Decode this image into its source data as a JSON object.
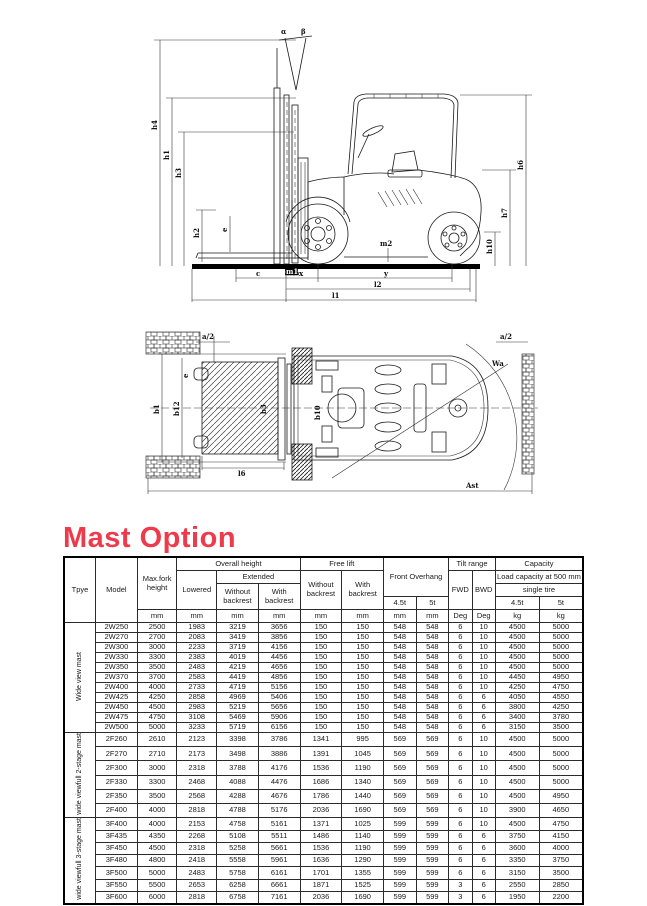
{
  "page": {
    "heading": "Mast Option",
    "heading_color": "#ee3b4b"
  },
  "side_view": {
    "labels": {
      "alpha": "α",
      "beta": "β",
      "h4": "h4",
      "h1": "h1",
      "h3": "h3",
      "h2": "h2",
      "e": "e",
      "m1": "m1",
      "m2": "m2",
      "h6": "h6",
      "h7": "h7",
      "h10": "h10",
      "c": "c",
      "x": "x",
      "y": "y",
      "l2": "l2",
      "l1": "l1"
    }
  },
  "top_view": {
    "labels": {
      "a2_left": "a/2",
      "a2_right": "a/2",
      "e": "e",
      "b1": "b1",
      "b12": "b12",
      "b3": "b3",
      "b10": "b10",
      "wa": "Wa",
      "l6": "l6",
      "ast": "Ast"
    }
  },
  "table": {
    "header": {
      "type": "Tpye",
      "model": "Model",
      "max_fork_height": "Max.fork height",
      "overall_height": "Overall height",
      "lowered": "Lowered",
      "extended": "Extended",
      "ext_without": "Without backrest",
      "ext_with": "With backrest",
      "free_lift": "Free lift",
      "fl_without": "Without backrest",
      "fl_with": "With backrest",
      "front_overhang": "Front  Overhang",
      "tilt_range": "Tilt range",
      "fwd": "FWD",
      "bwd": "BWD",
      "capacity": "Capacity",
      "load_capacity": "Load capacity at 500 mm",
      "single_tire": "single tire",
      "fo_45": "4.5t",
      "fo_5": "5t",
      "cap_45": "4.5t",
      "cap_5": "5t",
      "units": [
        "mm",
        "mm",
        "mm",
        "mm",
        "mm",
        "mm",
        "mm",
        "mm",
        "Deg",
        "Deg",
        "kg",
        "kg"
      ]
    },
    "groups": [
      {
        "type": "Wide view mast",
        "rows": [
          [
            "2W250",
            "2500",
            "1983",
            "3219",
            "3656",
            "150",
            "150",
            "548",
            "548",
            "6",
            "10",
            "4500",
            "5000"
          ],
          [
            "2W270",
            "2700",
            "2083",
            "3419",
            "3856",
            "150",
            "150",
            "548",
            "548",
            "6",
            "10",
            "4500",
            "5000"
          ],
          [
            "2W300",
            "3000",
            "2233",
            "3719",
            "4156",
            "150",
            "150",
            "548",
            "548",
            "6",
            "10",
            "4500",
            "5000"
          ],
          [
            "2W330",
            "3300",
            "2383",
            "4019",
            "4456",
            "150",
            "150",
            "548",
            "548",
            "6",
            "10",
            "4500",
            "5000"
          ],
          [
            "2W350",
            "3500",
            "2483",
            "4219",
            "4656",
            "150",
            "150",
            "548",
            "548",
            "6",
            "10",
            "4500",
            "5000"
          ],
          [
            "2W370",
            "3700",
            "2583",
            "4419",
            "4856",
            "150",
            "150",
            "548",
            "548",
            "6",
            "10",
            "4450",
            "4950"
          ],
          [
            "2W400",
            "4000",
            "2733",
            "4719",
            "5156",
            "150",
            "150",
            "548",
            "548",
            "6",
            "10",
            "4250",
            "4750"
          ],
          [
            "2W425",
            "4250",
            "2858",
            "4969",
            "5406",
            "150",
            "150",
            "548",
            "548",
            "6",
            "6",
            "4050",
            "4550"
          ],
          [
            "2W450",
            "4500",
            "2983",
            "5219",
            "5656",
            "150",
            "150",
            "548",
            "548",
            "6",
            "6",
            "3800",
            "4250"
          ],
          [
            "2W475",
            "4750",
            "3108",
            "5469",
            "5906",
            "150",
            "150",
            "548",
            "548",
            "6",
            "6",
            "3400",
            "3780"
          ],
          [
            "2W500",
            "5000",
            "3233",
            "5719",
            "6156",
            "150",
            "150",
            "548",
            "548",
            "6",
            "6",
            "3150",
            "3500"
          ]
        ]
      },
      {
        "type": "wide viewfull 2-stage mast",
        "rows": [
          [
            "2F260",
            "2610",
            "2123",
            "3398",
            "3786",
            "1341",
            "995",
            "569",
            "569",
            "6",
            "10",
            "4500",
            "5000"
          ],
          [
            "2F270",
            "2710",
            "2173",
            "3498",
            "3886",
            "1391",
            "1045",
            "569",
            "569",
            "6",
            "10",
            "4500",
            "5000"
          ],
          [
            "2F300",
            "3000",
            "2318",
            "3788",
            "4176",
            "1536",
            "1190",
            "569",
            "569",
            "6",
            "10",
            "4500",
            "5000"
          ],
          [
            "2F330",
            "3300",
            "2468",
            "4088",
            "4476",
            "1686",
            "1340",
            "569",
            "569",
            "6",
            "10",
            "4500",
            "5000"
          ],
          [
            "2F350",
            "3500",
            "2568",
            "4288",
            "4676",
            "1786",
            "1440",
            "569",
            "569",
            "6",
            "10",
            "4500",
            "4950"
          ],
          [
            "2F400",
            "4000",
            "2818",
            "4788",
            "5176",
            "2036",
            "1690",
            "569",
            "569",
            "6",
            "10",
            "3900",
            "4650"
          ]
        ]
      },
      {
        "type": "wide viewfull 3-stage mast",
        "rows": [
          [
            "3F400",
            "4000",
            "2153",
            "4758",
            "5161",
            "1371",
            "1025",
            "599",
            "599",
            "6",
            "10",
            "4500",
            "4750"
          ],
          [
            "3F435",
            "4350",
            "2268",
            "5108",
            "5511",
            "1486",
            "1140",
            "599",
            "599",
            "6",
            "6",
            "3750",
            "4150"
          ],
          [
            "3F450",
            "4500",
            "2318",
            "5258",
            "5661",
            "1536",
            "1190",
            "599",
            "599",
            "6",
            "6",
            "3600",
            "4000"
          ],
          [
            "3F480",
            "4800",
            "2418",
            "5558",
            "5961",
            "1636",
            "1290",
            "599",
            "599",
            "6",
            "6",
            "3350",
            "3750"
          ],
          [
            "3F500",
            "5000",
            "2483",
            "5758",
            "6161",
            "1701",
            "1355",
            "599",
            "599",
            "6",
            "6",
            "3150",
            "3500"
          ],
          [
            "3F550",
            "5500",
            "2653",
            "6258",
            "6661",
            "1871",
            "1525",
            "599",
            "599",
            "3",
            "6",
            "2550",
            "2850"
          ],
          [
            "3F600",
            "6000",
            "2818",
            "6758",
            "7161",
            "2036",
            "1690",
            "599",
            "599",
            "3",
            "6",
            "1950",
            "2200"
          ]
        ]
      }
    ]
  }
}
